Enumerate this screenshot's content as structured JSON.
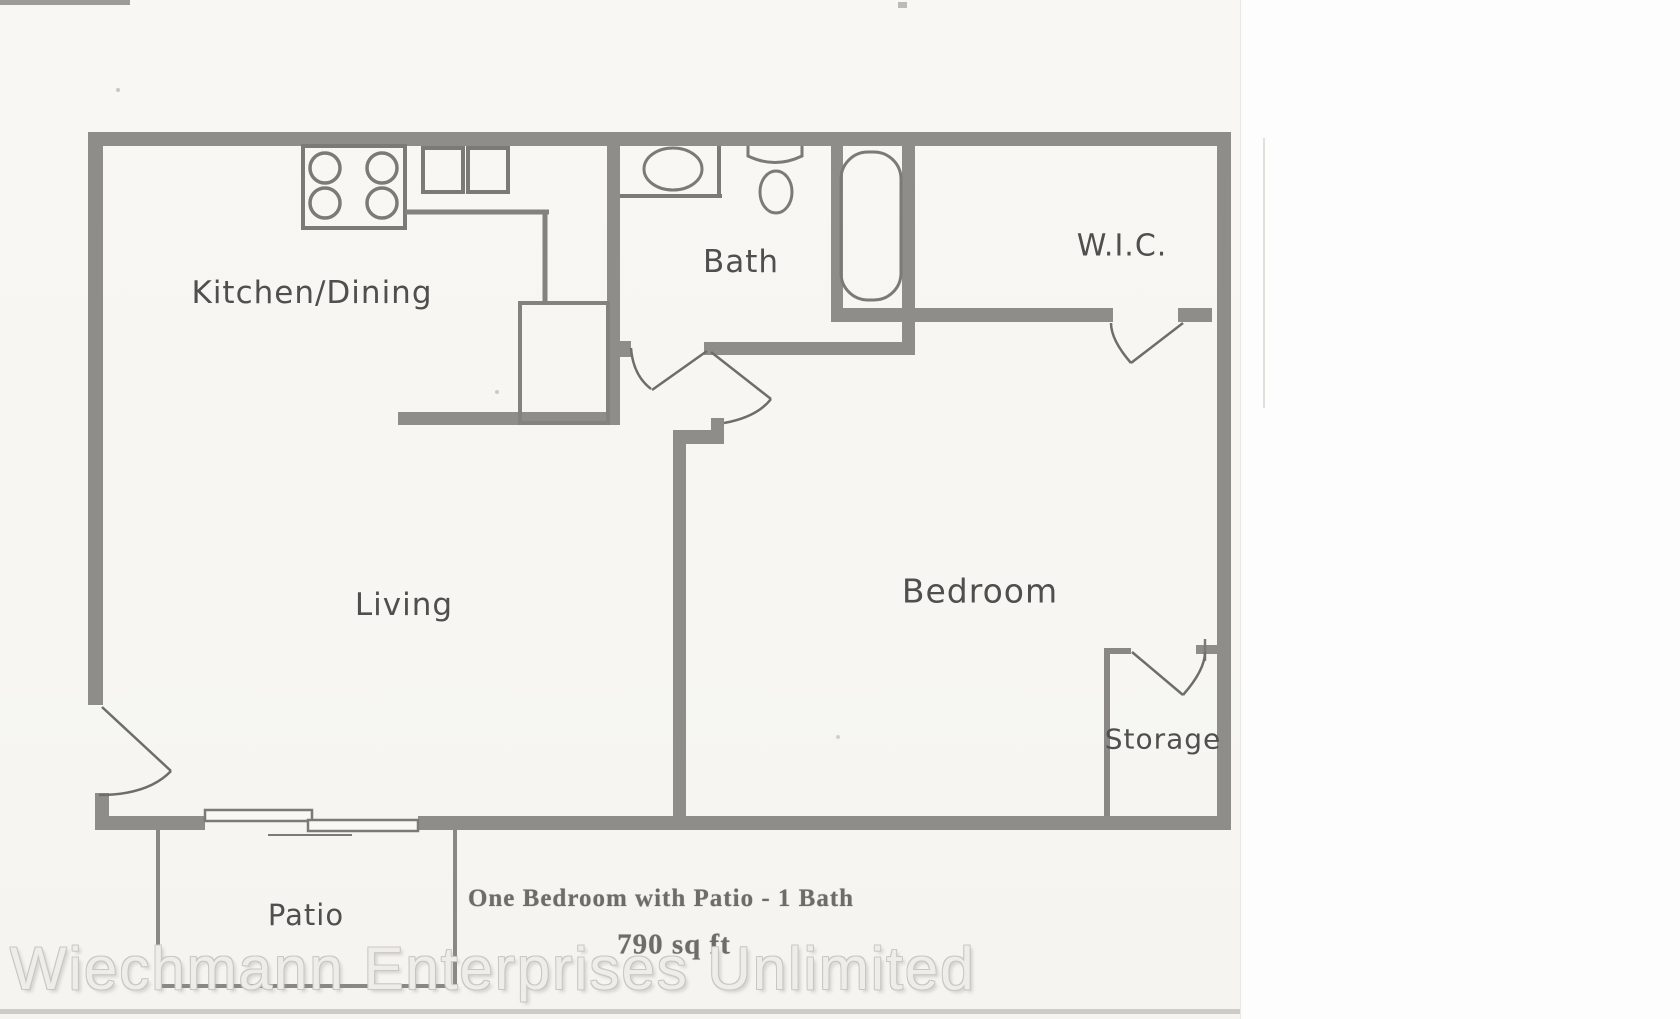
{
  "floorplan": {
    "rooms": [
      {
        "id": "kitchen-dining",
        "label": "Kitchen/Dining"
      },
      {
        "id": "bath",
        "label": "Bath"
      },
      {
        "id": "wic",
        "label": "W.I.C."
      },
      {
        "id": "living",
        "label": "Living"
      },
      {
        "id": "bedroom",
        "label": "Bedroom"
      },
      {
        "id": "storage",
        "label": "Storage"
      },
      {
        "id": "patio",
        "label": "Patio"
      }
    ],
    "caption": {
      "line1": "One Bedroom with Patio - 1 Bath",
      "line2": "790 sq ft"
    },
    "watermark": "Wiechmann Enterprises Unlimited",
    "fixtures": [
      "stove-icon",
      "double-sink-icon",
      "kitchen-counter",
      "pantry-box",
      "vanity-sink-icon",
      "toilet-icon",
      "bathtub-icon",
      "sliding-door-icon",
      "entry-door-icon",
      "bath-door-icon",
      "bedroom-door-icon",
      "wic-door-icon",
      "storage-door-icon"
    ],
    "colors": {
      "wall": "#8f8d89",
      "fixture_line": "#7c7a77",
      "door_line": "#6f6d6a",
      "paper": "#f7f6f2",
      "label_text": "#514f4d",
      "caption_text": "#6e6c69",
      "watermark_fill": "#eeedea",
      "watermark_outline": "#c9c7c3"
    }
  }
}
